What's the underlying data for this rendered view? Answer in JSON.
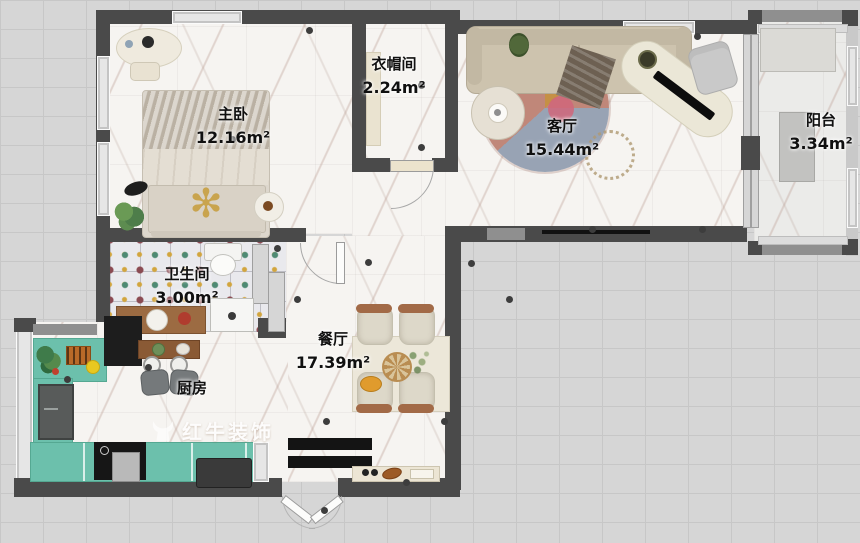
{
  "plan_title": "apartment-floor-plan",
  "rooms": [
    {
      "id": "master-bedroom",
      "name": "主卧",
      "area": "12.16m²"
    },
    {
      "id": "cloakroom",
      "name": "衣帽间",
      "area": "2.24m²"
    },
    {
      "id": "living-room",
      "name": "客厅",
      "area": "15.44m²"
    },
    {
      "id": "balcony",
      "name": "阳台",
      "area": "3.34m²"
    },
    {
      "id": "bathroom",
      "name": "卫生间",
      "area": "3.00m²"
    },
    {
      "id": "dining-room",
      "name": "餐厅",
      "area": "17.39m²"
    },
    {
      "id": "kitchen",
      "name": "厨房",
      "area": ""
    }
  ],
  "watermark": {
    "text": "红牛装饰"
  },
  "colors": {
    "background": "#d6d6d6",
    "wall": "#4a4a4a",
    "floor_marble": "#f6f4f1",
    "kitchen_counter": "#6cc0ac",
    "rug_main": "#c08779",
    "rug_accent_blue": "#98a3b4",
    "rug_accent_orange": "#c59045",
    "bath_tile_teal": "#4e8a74",
    "bath_tile_maroon": "#8a4a52",
    "bath_tile_yellow": "#d2a53e",
    "dining_chair_wood": "#a26a47"
  }
}
